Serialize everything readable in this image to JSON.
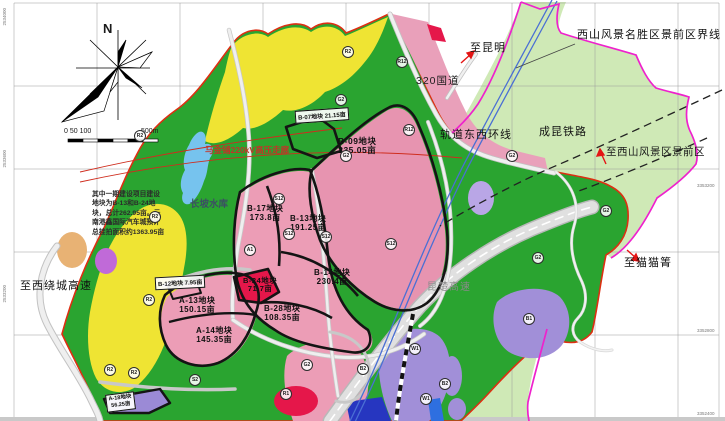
{
  "compass": {
    "north_label": "N"
  },
  "scale_bar": {
    "start_labels": "0 50 100",
    "end_label": "500m"
  },
  "note": {
    "line1": "其中一期建设项目建设",
    "line2": "地块为B-13和B-24地",
    "line3": "块，总计262.95亩。云",
    "line4": "南港鑫国际汽车城预计",
    "line5": "总挂拍面积约1363.95亩"
  },
  "labels": {
    "to_kunming": "至昆明",
    "scenic_boundary": "西山风景名胜区景前区界线",
    "national_road_g320": "320国道",
    "metro_east_west_line": "轨道东西环线",
    "chengkun_railway": "成昆铁路",
    "to_xishan_scenic_area": "至西山风景区景前区",
    "to_maomaoqing": "至猫猫箐",
    "to_west_ring_expressway": "至西绕城高速",
    "kunchu_expressway": "昆楚高速",
    "power_corridor": "马金铺220kV高压走廊",
    "reservoir": "长坡水库"
  },
  "plots": {
    "b07": {
      "text": "B-07地块  21.15亩"
    },
    "b09": {
      "name": "B-09地块",
      "area": "235.05亩"
    },
    "b12": {
      "text": "B-12地块  7.95亩"
    },
    "b13": {
      "name": "B-13地块",
      "area": "191.25亩"
    },
    "b14": {
      "name": "B-14地块",
      "area": "230.4亩"
    },
    "b17": {
      "name": "B-17地块",
      "area": "173.8亩"
    },
    "b24": {
      "name": "B-24地块",
      "area": "71.7亩"
    },
    "b28": {
      "name": "B-28地块",
      "area": "108.35亩"
    },
    "a13": {
      "name": "A-13地块",
      "area": "150.15亩"
    },
    "a14": {
      "name": "A-14地块",
      "area": "145.35亩"
    },
    "a18": {
      "name": "A-18地块",
      "area": "56.25亩"
    }
  },
  "zone_codes": [
    {
      "code": "R2"
    },
    {
      "code": "R2"
    },
    {
      "code": "R2"
    },
    {
      "code": "G2"
    },
    {
      "code": "R12"
    },
    {
      "code": "R12"
    },
    {
      "code": "G2"
    },
    {
      "code": "S12"
    },
    {
      "code": "S12"
    },
    {
      "code": "S12"
    },
    {
      "code": "S12"
    },
    {
      "code": "A1"
    },
    {
      "code": "G2"
    },
    {
      "code": "G2"
    },
    {
      "code": "G2"
    },
    {
      "code": "B1"
    },
    {
      "code": "W1"
    },
    {
      "code": "W1"
    },
    {
      "code": "R1"
    },
    {
      "code": "B2"
    },
    {
      "code": "G2"
    },
    {
      "code": "B2"
    },
    {
      "code": "R2"
    },
    {
      "code": "R2"
    },
    {
      "code": "R2"
    },
    {
      "code": "S2"
    }
  ],
  "edge_coords": [
    "2534000",
    "2533600",
    "2533200",
    "3353200",
    "3352800",
    "3352400"
  ],
  "legend_colors": {
    "residential_yellow": "#efe433",
    "commercial_pink": "#ec9db6",
    "green_space": "#2aa430",
    "scenic_light_green": "#cfe9b6",
    "warehouse_purple": "#a18fd8",
    "red_plot": "#e5174a",
    "water_blue": "#76c3ee",
    "boundary_magenta": "#ee22cc",
    "boundary_red": "#dd2f12",
    "metro_blue": "#4a6fd4"
  }
}
